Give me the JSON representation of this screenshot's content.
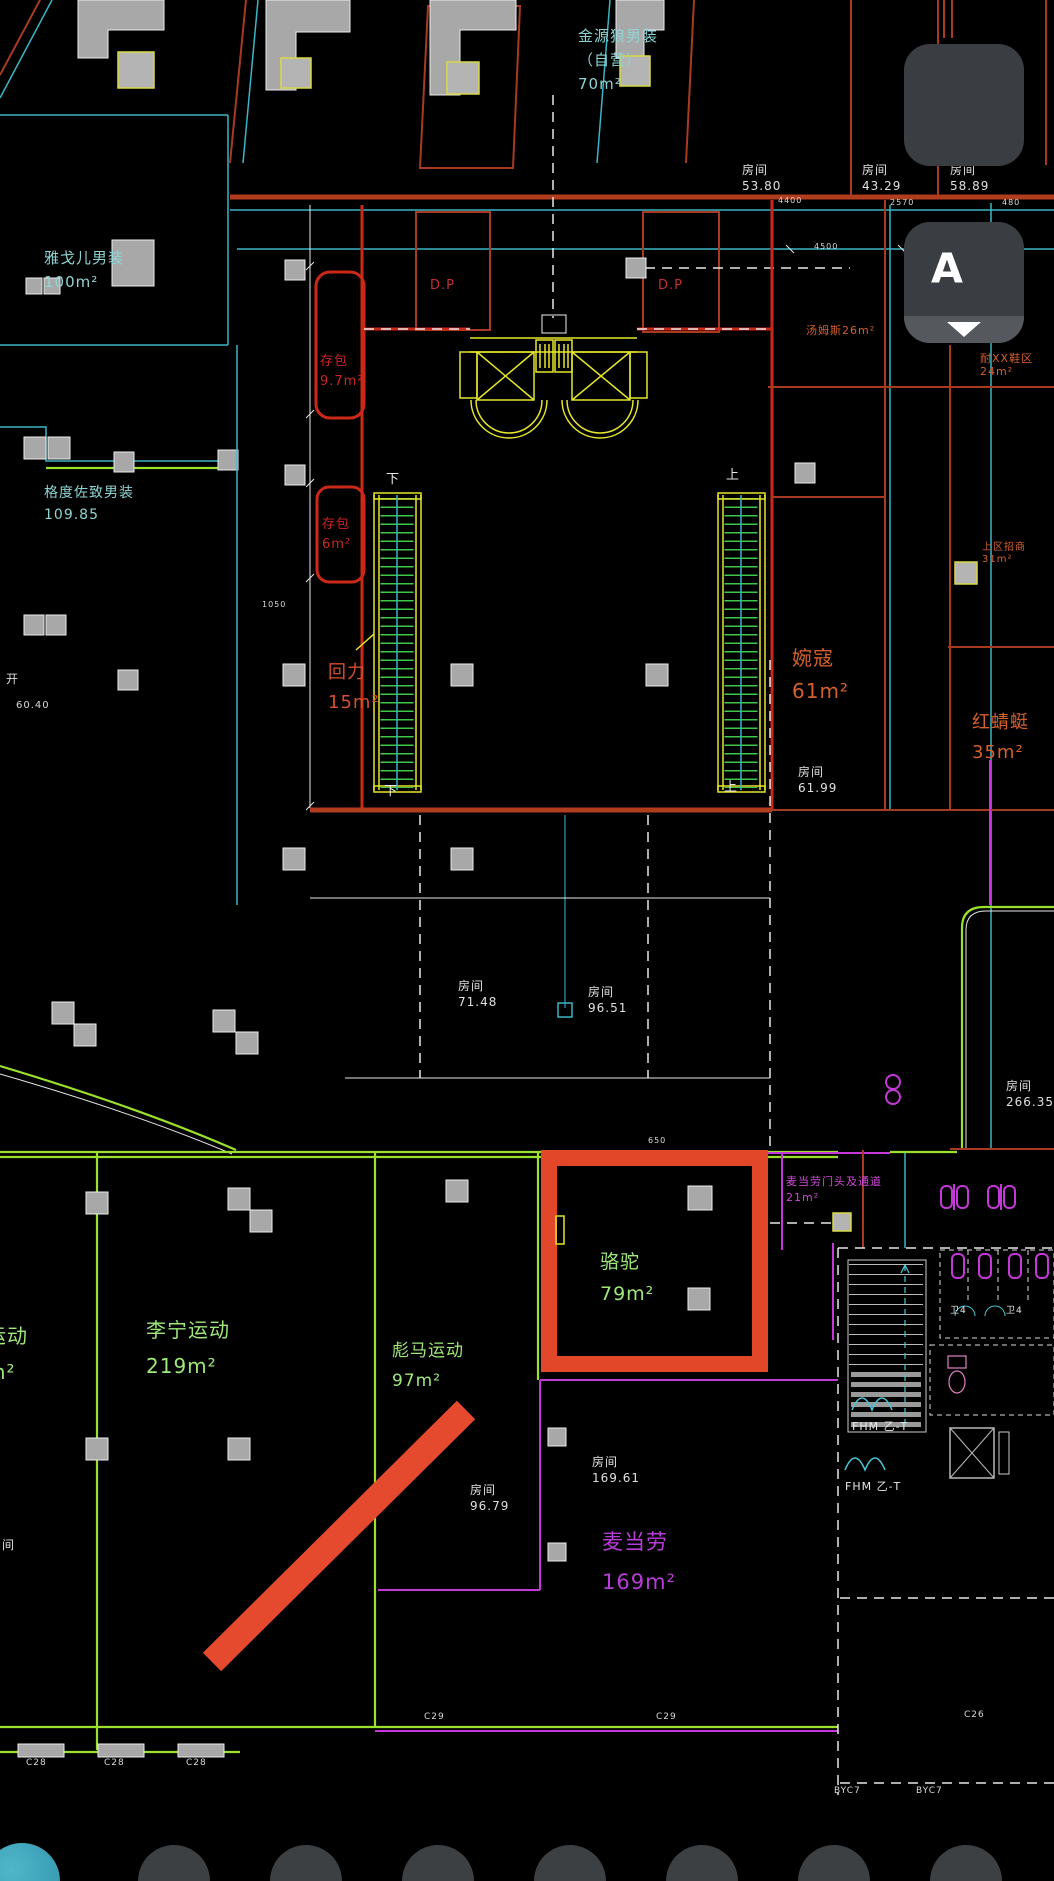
{
  "canvas": {
    "width": 1054,
    "height": 1881
  },
  "colors": {
    "background": "#000000",
    "wall_red": "#a83a22",
    "bright_red": "#cc2818",
    "cyan": "#3bb6c4",
    "green_line": "#9ae02c",
    "yellow": "#e6e62a",
    "magenta": "#c438d8",
    "highlight_box": "#e2472a",
    "arrow": "#e64a2e",
    "text_green": "#9fe87a",
    "text_cyan": "#8fd4d4",
    "text_orange": "#d4602c",
    "text_red": "#cc2525",
    "text_white": "#e0e0e0",
    "button_bg": "#3a3d41",
    "button_strip": "#55585c"
  },
  "floating_buttons": {
    "chat": {
      "icon": "chat-bubbles-icon"
    },
    "annotation": {
      "icon": "text-annotation-icon",
      "chevron": "chevron-down-icon"
    }
  },
  "bottom_toolbar": {
    "circle_count": 8,
    "accent_circle_color": "#2f93ab",
    "circle_color": "#3c4043"
  },
  "highlight": {
    "store": "骆驼",
    "area": "79m²",
    "box_color": "#e2472a",
    "arrow_color": "#e64a2e"
  },
  "labels": [
    {
      "name": "store-label-jinyuanlang",
      "text": "金源狼男装\n（自营）\n70m²",
      "x": 578,
      "y": 24,
      "fs": 15,
      "lh": 24,
      "color": "#8fd4d4"
    },
    {
      "name": "room-label",
      "text": "房间\n53.80",
      "x": 742,
      "y": 162,
      "fs": 12,
      "lh": 16,
      "color": "#e0e0e0"
    },
    {
      "name": "room-label",
      "text": "房间\n43.29",
      "x": 862,
      "y": 162,
      "fs": 12,
      "lh": 16,
      "color": "#e0e0e0"
    },
    {
      "name": "room-label",
      "text": "房间\n58.89",
      "x": 950,
      "y": 162,
      "fs": 12,
      "lh": 16,
      "color": "#e0e0e0"
    },
    {
      "name": "store-label-yageer",
      "text": "雅戈儿男装\n100m²",
      "x": 44,
      "y": 246,
      "fs": 15,
      "lh": 24,
      "color": "#8fd4d4"
    },
    {
      "name": "store-label-gedu",
      "text": "格度佐致男装\n109.85",
      "x": 44,
      "y": 482,
      "fs": 14,
      "lh": 22,
      "color": "#8fd4d4"
    },
    {
      "name": "dim-label",
      "text": "60.40",
      "x": 16,
      "y": 700,
      "fs": 10,
      "lh": 12,
      "color": "#d8d8d8"
    },
    {
      "name": "text-label",
      "text": "开",
      "x": 6,
      "y": 672,
      "fs": 12,
      "lh": 14,
      "color": "#d8d8d8"
    },
    {
      "name": "store-label-cunbao1",
      "text": "存包\n9.7m²",
      "x": 320,
      "y": 352,
      "fs": 13,
      "lh": 20,
      "color": "#cc2525"
    },
    {
      "name": "store-label-cunbao2",
      "text": "存包\n6m²",
      "x": 322,
      "y": 515,
      "fs": 13,
      "lh": 20,
      "color": "#cc2525"
    },
    {
      "name": "store-label-huili",
      "text": "回力\n15m²",
      "x": 328,
      "y": 658,
      "fs": 18,
      "lh": 30,
      "color": "#d4502c"
    },
    {
      "name": "store-label-wankou",
      "text": "婉寇\n61m²",
      "x": 792,
      "y": 642,
      "fs": 20,
      "lh": 33,
      "color": "#d4602c"
    },
    {
      "name": "room-label",
      "text": "房间\n61.99",
      "x": 798,
      "y": 764,
      "fs": 12,
      "lh": 16,
      "color": "#e0e0e0"
    },
    {
      "name": "store-label-hongqingting",
      "text": "红蜻蜓\n35m²",
      "x": 972,
      "y": 708,
      "fs": 18,
      "lh": 30,
      "color": "#d4602c"
    },
    {
      "name": "store-label-tangmusi",
      "text": "汤姆斯26m²",
      "x": 806,
      "y": 324,
      "fs": 11,
      "lh": 13,
      "color": "#d4602c"
    },
    {
      "name": "store-label-shoes24",
      "text": "耐XX鞋区24m²",
      "x": 980,
      "y": 352,
      "fs": 11,
      "lh": 13,
      "color": "#d4602c"
    },
    {
      "name": "store-label-zhaoshang",
      "text": "上区招商31m²",
      "x": 982,
      "y": 542,
      "fs": 10,
      "lh": 12,
      "color": "#d4602c"
    },
    {
      "name": "dp-label",
      "text": "D.P",
      "x": 430,
      "y": 278,
      "fs": 13,
      "lh": 15,
      "color": "#c03030"
    },
    {
      "name": "dp-label",
      "text": "D.P",
      "x": 658,
      "y": 278,
      "fs": 13,
      "lh": 15,
      "color": "#c03030"
    },
    {
      "name": "escalator-down-label",
      "text": "下",
      "x": 386,
      "y": 472,
      "fs": 13,
      "lh": 15,
      "color": "#e8e8e8"
    },
    {
      "name": "escalator-down-label",
      "text": "下",
      "x": 384,
      "y": 784,
      "fs": 13,
      "lh": 15,
      "color": "#e8e8e8"
    },
    {
      "name": "escalator-up-label",
      "text": "上",
      "x": 726,
      "y": 468,
      "fs": 13,
      "lh": 15,
      "color": "#e8e8e8"
    },
    {
      "name": "escalator-up-label",
      "text": "上",
      "x": 724,
      "y": 780,
      "fs": 13,
      "lh": 15,
      "color": "#e8e8e8"
    },
    {
      "name": "room-label",
      "text": "房间\n71.48",
      "x": 458,
      "y": 978,
      "fs": 12,
      "lh": 16,
      "color": "#e0e0e0"
    },
    {
      "name": "room-label",
      "text": "房间\n96.51",
      "x": 588,
      "y": 984,
      "fs": 12,
      "lh": 16,
      "color": "#e0e0e0"
    },
    {
      "name": "room-label",
      "text": "房间\n266.35",
      "x": 1006,
      "y": 1078,
      "fs": 12,
      "lh": 16,
      "color": "#e0e0e0"
    },
    {
      "name": "store-label-luotuo",
      "text": "骆驼\n79m²",
      "x": 600,
      "y": 1246,
      "fs": 19,
      "lh": 32,
      "color": "#9fe87a"
    },
    {
      "name": "store-label-lining",
      "text": "李宁运动\n219m²",
      "x": 146,
      "y": 1312,
      "fs": 20,
      "lh": 36,
      "color": "#9fe87a"
    },
    {
      "name": "store-label-yundong",
      "text": "运动\nm²",
      "x": -14,
      "y": 1318,
      "fs": 20,
      "lh": 36,
      "color": "#9fe87a"
    },
    {
      "name": "store-label-biaoma",
      "text": "彪马运动\n97m²",
      "x": 392,
      "y": 1336,
      "fs": 17,
      "lh": 30,
      "color": "#9fe87a"
    },
    {
      "name": "label-mcd-passage",
      "text": "麦当劳门头及通道\n21m²",
      "x": 786,
      "y": 1174,
      "fs": 11,
      "lh": 16,
      "color": "#d048d8"
    },
    {
      "name": "room-label",
      "text": "房间\n169.61",
      "x": 592,
      "y": 1454,
      "fs": 12,
      "lh": 16,
      "color": "#e0e0e0"
    },
    {
      "name": "room-label",
      "text": "房间\n96.79",
      "x": 470,
      "y": 1482,
      "fs": 12,
      "lh": 16,
      "color": "#e0e0e0"
    },
    {
      "name": "store-label-mcdonalds",
      "text": "麦当劳\n169m²",
      "x": 602,
      "y": 1522,
      "fs": 21,
      "lh": 40,
      "color": "#b83cd8"
    },
    {
      "name": "fhm-label",
      "text": "FHM 乙-T",
      "x": 852,
      "y": 1420,
      "fs": 11,
      "lh": 13,
      "color": "#e8e8e8"
    },
    {
      "name": "fhm-label",
      "text": "FHM 乙-T",
      "x": 845,
      "y": 1480,
      "fs": 11,
      "lh": 13,
      "color": "#e8e8e8"
    },
    {
      "name": "wc-label",
      "text": "卫4",
      "x": 950,
      "y": 1306,
      "fs": 9,
      "lh": 11,
      "color": "#e8e8e8"
    },
    {
      "name": "wc-label",
      "text": "卫4",
      "x": 1006,
      "y": 1306,
      "fs": 9,
      "lh": 11,
      "color": "#e8e8e8"
    },
    {
      "name": "grid-label",
      "text": "BYC7",
      "x": 834,
      "y": 1786,
      "fs": 9,
      "lh": 11,
      "color": "#d8d8d8"
    },
    {
      "name": "grid-label",
      "text": "BYC7",
      "x": 916,
      "y": 1786,
      "fs": 9,
      "lh": 11,
      "color": "#d8d8d8"
    },
    {
      "name": "grid-label",
      "text": "C28",
      "x": 26,
      "y": 1758,
      "fs": 9,
      "lh": 11,
      "color": "#d8d8d8"
    },
    {
      "name": "grid-label",
      "text": "C28",
      "x": 104,
      "y": 1758,
      "fs": 9,
      "lh": 11,
      "color": "#d8d8d8"
    },
    {
      "name": "grid-label",
      "text": "C28",
      "x": 186,
      "y": 1758,
      "fs": 9,
      "lh": 11,
      "color": "#d8d8d8"
    },
    {
      "name": "grid-label",
      "text": "C29",
      "x": 424,
      "y": 1712,
      "fs": 9,
      "lh": 11,
      "color": "#d8d8d8"
    },
    {
      "name": "grid-label",
      "text": "C29",
      "x": 656,
      "y": 1712,
      "fs": 9,
      "lh": 11,
      "color": "#d8d8d8"
    },
    {
      "name": "grid-label",
      "text": "C26",
      "x": 964,
      "y": 1710,
      "fs": 9,
      "lh": 11,
      "color": "#d8d8d8"
    },
    {
      "name": "dim-label",
      "text": "4400",
      "x": 778,
      "y": 196,
      "fs": 8,
      "lh": 10,
      "color": "#d8d8d8"
    },
    {
      "name": "dim-label",
      "text": "2570",
      "x": 890,
      "y": 198,
      "fs": 8,
      "lh": 10,
      "color": "#d8d8d8"
    },
    {
      "name": "dim-label",
      "text": "480",
      "x": 1002,
      "y": 198,
      "fs": 8,
      "lh": 10,
      "color": "#d8d8d8"
    },
    {
      "name": "dim-label",
      "text": "4500",
      "x": 814,
      "y": 242,
      "fs": 8,
      "lh": 10,
      "color": "#d8d8d8"
    },
    {
      "name": "dim-label",
      "text": "650",
      "x": 648,
      "y": 1136,
      "fs": 8,
      "lh": 10,
      "color": "#d8d8d8"
    },
    {
      "name": "dim-label",
      "text": "1050",
      "x": 262,
      "y": 600,
      "fs": 8,
      "lh": 10,
      "color": "#d8d8d8"
    },
    {
      "name": "dim-label",
      "text": "109.85",
      "x": 0,
      "y": 0,
      "fs": 0,
      "lh": 0,
      "color": "#00000000"
    },
    {
      "name": "room-label-partial",
      "text": "间",
      "x": 2,
      "y": 1538,
      "fs": 12,
      "lh": 14,
      "color": "#e0e0e0"
    }
  ]
}
